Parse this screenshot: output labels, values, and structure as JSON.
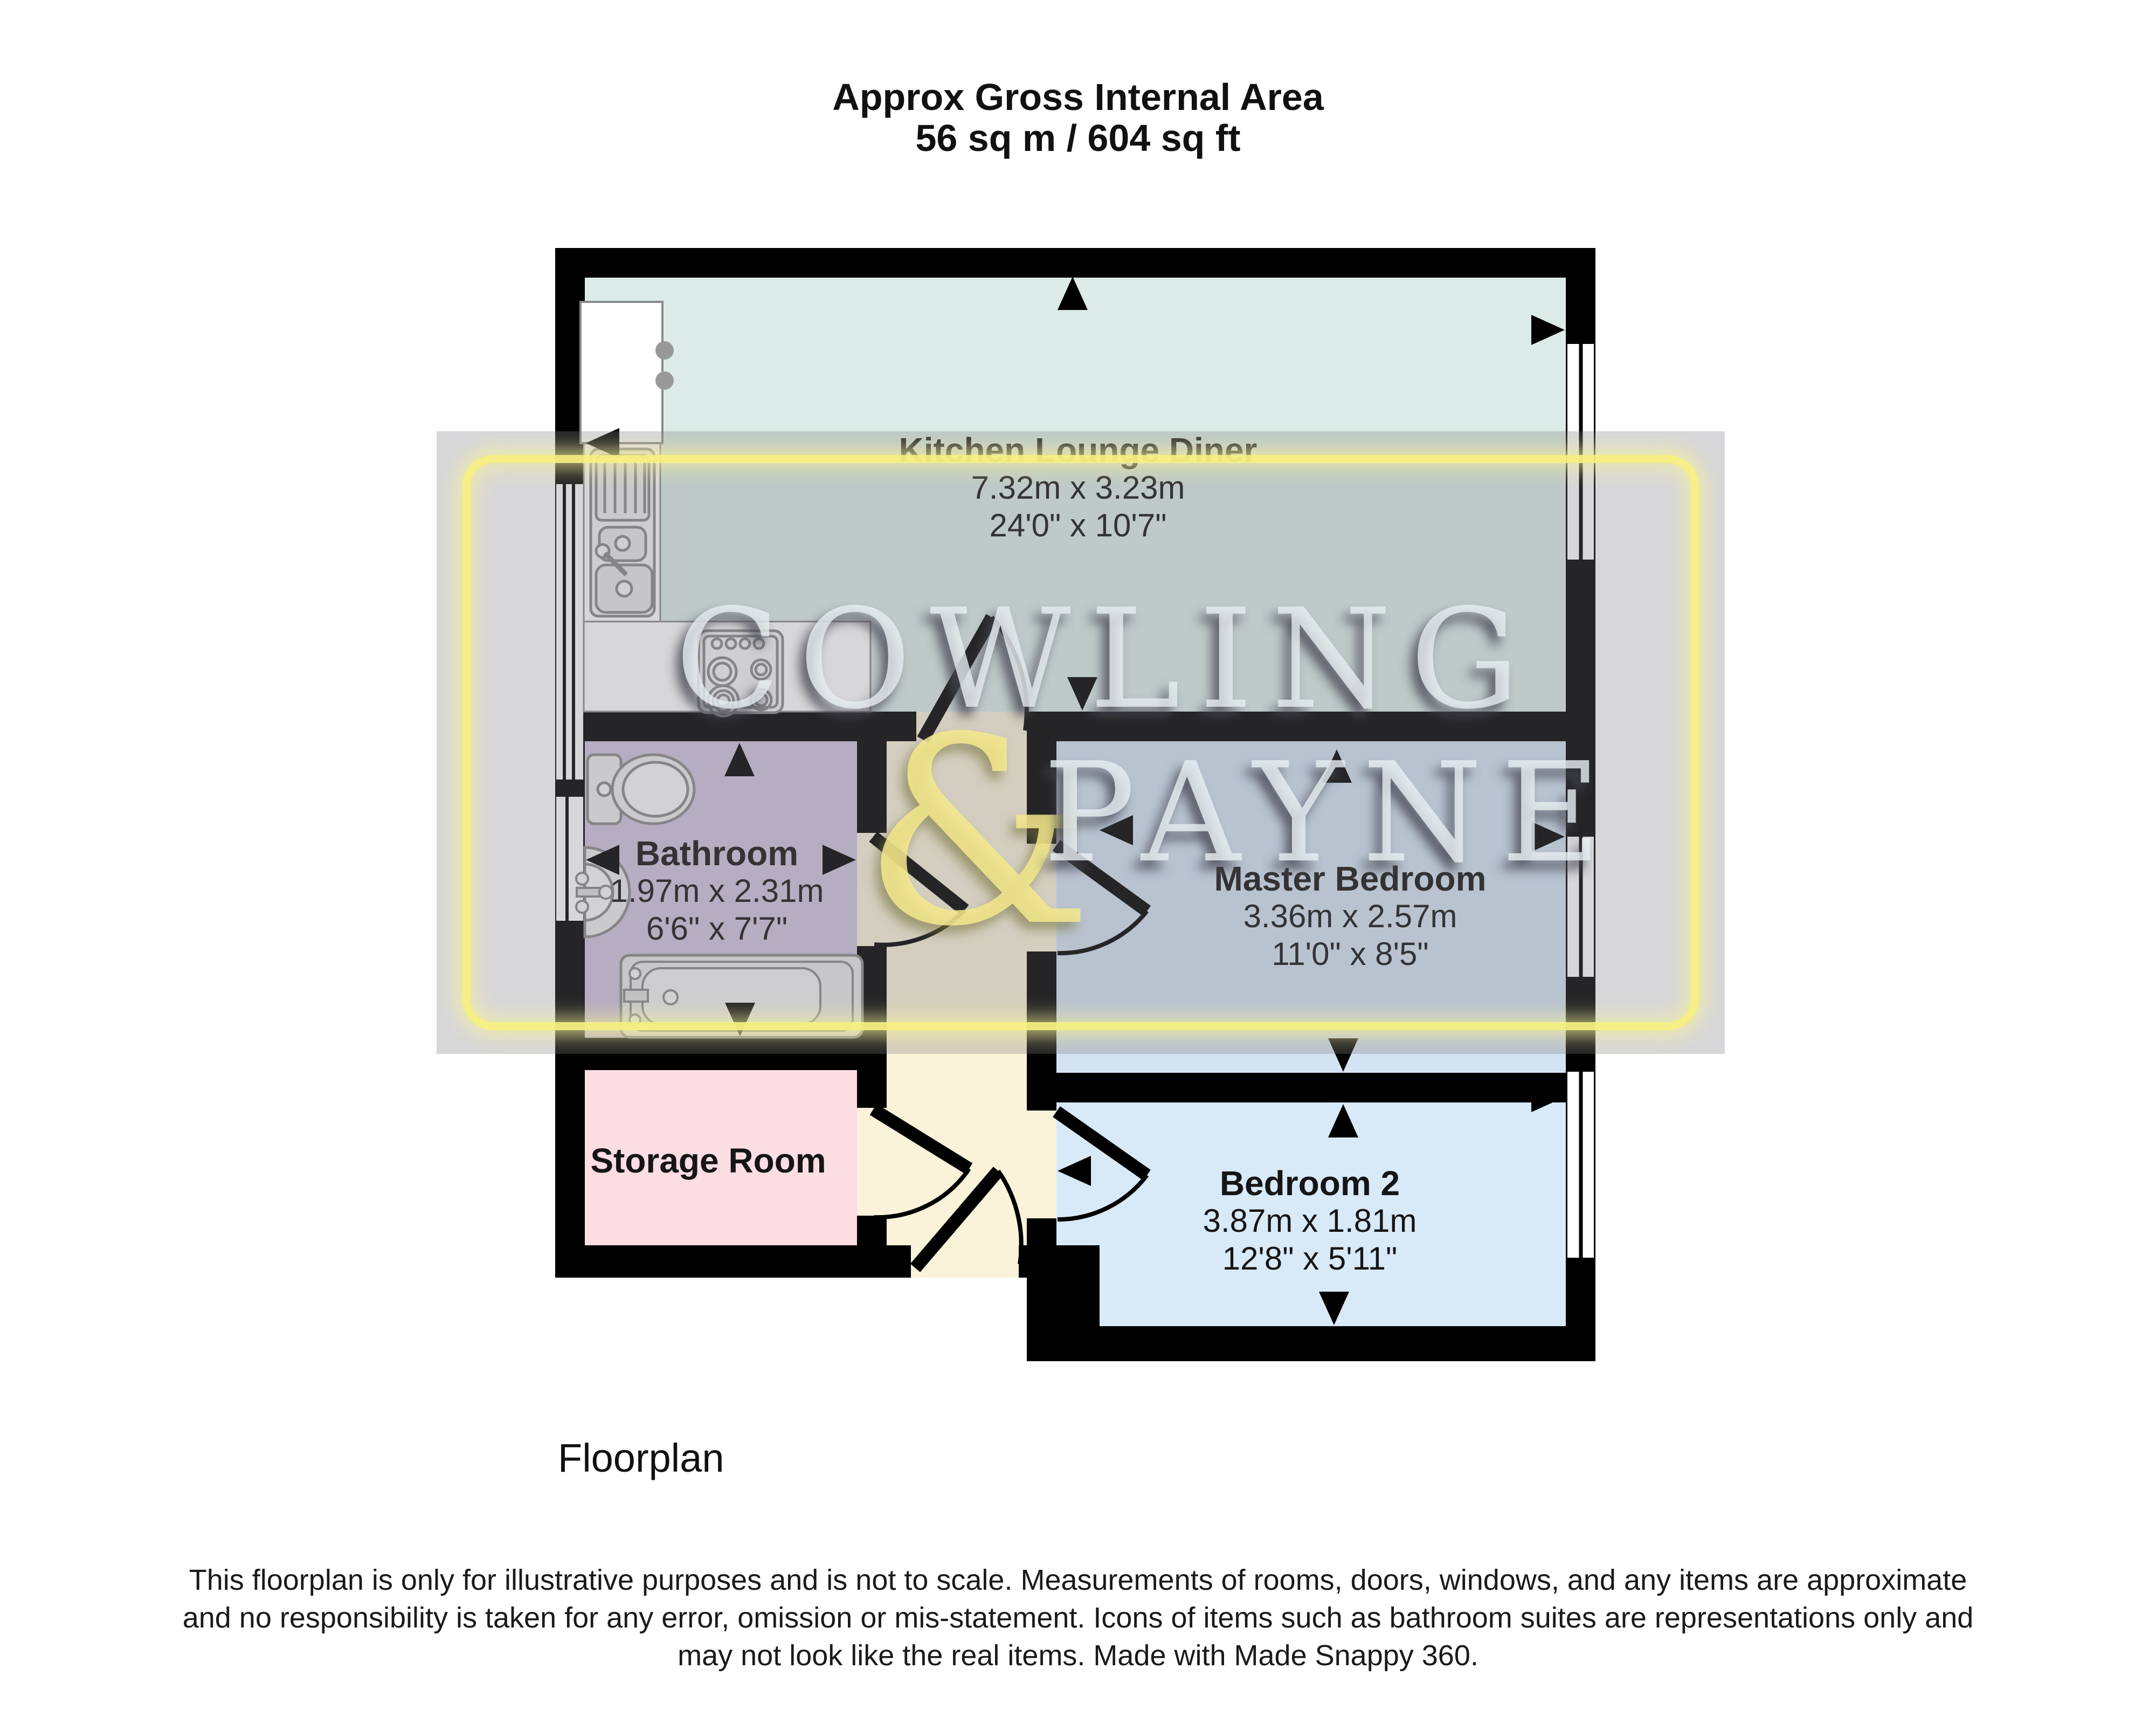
{
  "title": {
    "line1": "Approx Gross Internal Area",
    "line2": "56 sq m / 604 sq ft"
  },
  "rooms": {
    "kitchen": {
      "name": "Kitchen Lounge Diner",
      "dim_m": "7.32m x 3.23m",
      "dim_ft": "24'0\" x 10'7\"",
      "color": "#dcebe7"
    },
    "bathroom": {
      "name": "Bathroom",
      "dim_m": "1.97m x 2.31m",
      "dim_ft": "6'6\" x 7'7\"",
      "color": "#cfc3dd"
    },
    "master": {
      "name": "Master Bedroom",
      "dim_m": "3.36m x 2.57m",
      "dim_ft": "11'0\" x 8'5\"",
      "color": "#d4e3f2"
    },
    "bedroom2": {
      "name": "Bedroom 2",
      "dim_m": "3.87m x 1.81m",
      "dim_ft": "12'8\" x 5'11\"",
      "color": "#d8e9f8"
    },
    "storage": {
      "name": "Storage Room",
      "color": "#fbdde2"
    },
    "hallway": {
      "color": "#faf3da"
    }
  },
  "watermark": {
    "line1": "COWLING",
    "amp": "&",
    "line2": "PAYNE",
    "border_color": "#f7f082",
    "text_color": "#e9f0f2",
    "amp_color": "#f5e98c"
  },
  "plan_label": "Floorplan",
  "disclaimer": {
    "lines": [
      "This floorplan is only for illustrative purposes and is not to scale. Measurements of rooms, doors, windows, and any items are approximate",
      "and no responsibility is taken for any error, omission or mis-statement. Icons of items such as bathroom suites are representations only and",
      "may not look like the real items. Made with Made Snappy 360."
    ]
  },
  "colors": {
    "wall": "#000000",
    "arrow": "#000000",
    "fixture_stroke": "#8a8a8a",
    "fixture_fill": "#efefef",
    "window_fill": "#ffffff"
  },
  "icons": {
    "direction_arrows": [
      "up-arrow-icon",
      "down-arrow-icon",
      "left-arrow-icon",
      "right-arrow-icon"
    ],
    "fixtures": [
      "kitchen-sink-icon",
      "hob-icon",
      "toilet-icon",
      "basin-icon",
      "bathtub-icon"
    ]
  }
}
